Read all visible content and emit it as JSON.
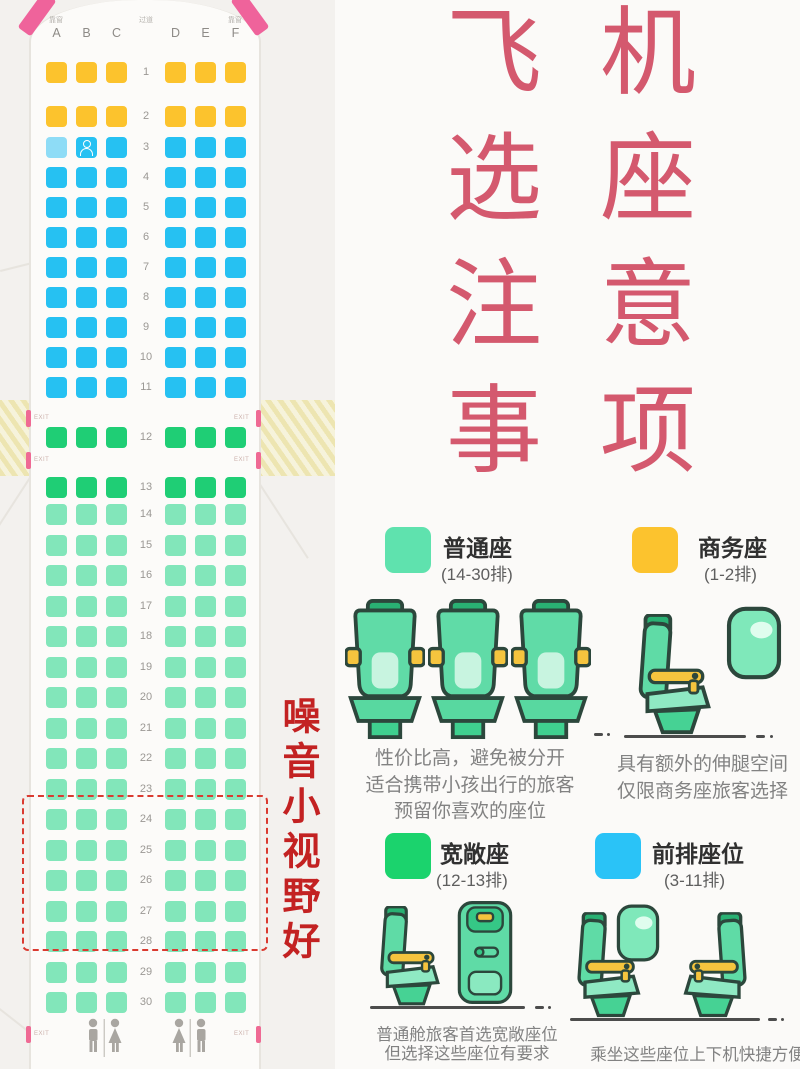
{
  "title": {
    "color": "#d4596e",
    "col1": [
      "飞",
      "选",
      "注",
      "事"
    ],
    "col2": [
      "机",
      "座",
      "意",
      "项"
    ]
  },
  "side_note": {
    "text": "噪音小视野好",
    "color": "#c32222"
  },
  "seatmap": {
    "window_label": "靠窗",
    "aisle_label": "过道",
    "exit_label": "EXIT",
    "columns": [
      "A",
      "B",
      "C",
      "D",
      "E",
      "F"
    ],
    "selected_seat": "3A",
    "occupied_seat": "3B",
    "selected_color": "#8edcf6",
    "highlight_rows": "24-28",
    "lavatory_icon": "male-female-restroom-figures",
    "classes": {
      "business": {
        "label": "商务座",
        "color": "#fcc32d"
      },
      "front": {
        "label": "前排座位",
        "color": "#26c1f2"
      },
      "spacious": {
        "label": "宽敞座",
        "color": "#1fce75"
      },
      "normal": {
        "label": "普通座",
        "color": "#82e6ba"
      }
    },
    "rows": [
      {
        "n": 1,
        "t": "business"
      },
      {
        "n": 2,
        "t": "business"
      },
      {
        "n": 3,
        "t": "front"
      },
      {
        "n": 4,
        "t": "front"
      },
      {
        "n": 5,
        "t": "front"
      },
      {
        "n": 6,
        "t": "front"
      },
      {
        "n": 7,
        "t": "front"
      },
      {
        "n": 8,
        "t": "front"
      },
      {
        "n": 9,
        "t": "front"
      },
      {
        "n": 10,
        "t": "front"
      },
      {
        "n": 11,
        "t": "front"
      },
      {
        "n": 12,
        "t": "spacious"
      },
      {
        "n": 13,
        "t": "spacious"
      },
      {
        "n": 14,
        "t": "normal"
      },
      {
        "n": 15,
        "t": "normal"
      },
      {
        "n": 16,
        "t": "normal"
      },
      {
        "n": 17,
        "t": "normal"
      },
      {
        "n": 18,
        "t": "normal"
      },
      {
        "n": 19,
        "t": "normal"
      },
      {
        "n": 20,
        "t": "normal"
      },
      {
        "n": 21,
        "t": "normal"
      },
      {
        "n": 22,
        "t": "normal"
      },
      {
        "n": 23,
        "t": "normal"
      },
      {
        "n": 24,
        "t": "normal"
      },
      {
        "n": 25,
        "t": "normal"
      },
      {
        "n": 26,
        "t": "normal"
      },
      {
        "n": 27,
        "t": "normal"
      },
      {
        "n": 28,
        "t": "normal"
      },
      {
        "n": 29,
        "t": "normal"
      },
      {
        "n": 30,
        "t": "normal"
      }
    ]
  },
  "legend": {
    "items": [
      {
        "name": "普通座",
        "range": "(14-30排)",
        "color": "#5fe2ae",
        "desc": [
          "性价比高，避免被分开",
          "适合携带小孩出行的旅客",
          "预留你喜欢的座位"
        ]
      },
      {
        "name": "商务座",
        "range": "(1-2排)",
        "color": "#fcc32e",
        "desc": [
          "具有额外的伸腿空间",
          "仅限商务座旅客选择"
        ]
      },
      {
        "name": "宽敞座",
        "range": "(12-13排)",
        "color": "#1bd36d",
        "desc": [
          "普通舱旅客首选宽敞座位",
          "但选择这些座位有要求"
        ]
      },
      {
        "name": "前排座位",
        "range": "(3-11排)",
        "color": "#2ac3f7",
        "desc": [
          "乘坐这些座位上下机快捷方便"
        ]
      }
    ]
  }
}
